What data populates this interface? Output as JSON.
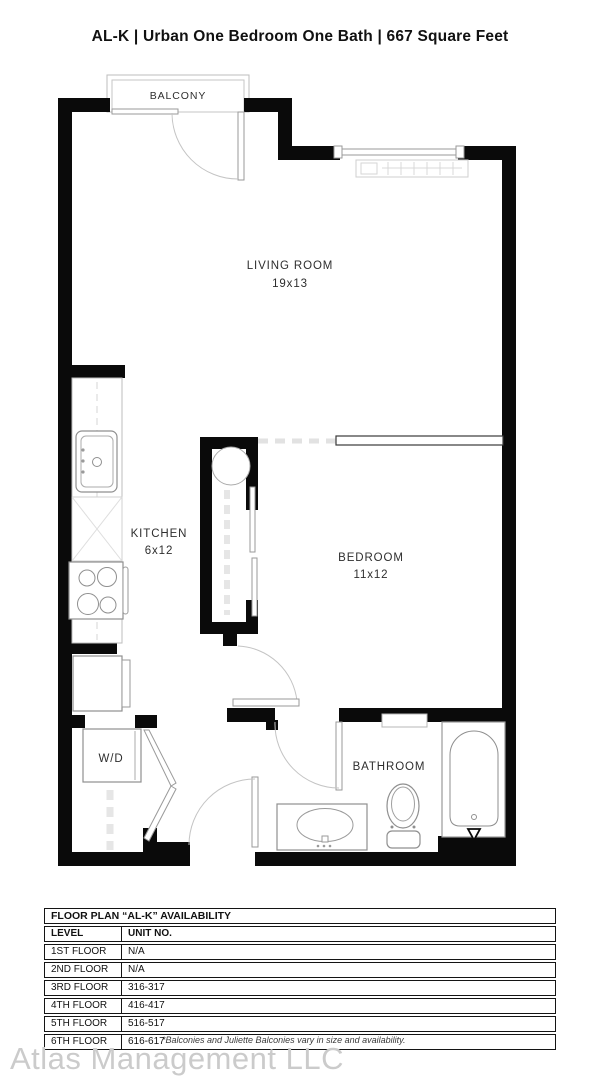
{
  "title": "AL-K | Urban One Bedroom One Bath | 667 Square Feet",
  "floor_plan": {
    "rooms": {
      "balcony": {
        "label": "BALCONY"
      },
      "living_room": {
        "label": "LIVING ROOM",
        "dimensions": "19x13"
      },
      "kitchen": {
        "label": "KITCHEN",
        "dimensions": "6x12"
      },
      "bedroom": {
        "label": "BEDROOM",
        "dimensions": "11x12"
      },
      "bathroom": {
        "label": "BATHROOM"
      },
      "washer_dryer": {
        "label": "W/D"
      }
    }
  },
  "availability_table": {
    "title": "FLOOR PLAN “AL-K” AVAILABILITY",
    "columns": [
      "LEVEL",
      "UNIT NO."
    ],
    "rows": [
      {
        "level": "1ST FLOOR",
        "unit_no": "N/A"
      },
      {
        "level": "2ND FLOOR",
        "unit_no": "N/A"
      },
      {
        "level": "3RD FLOOR",
        "unit_no": "316-317"
      },
      {
        "level": "4TH FLOOR",
        "unit_no": "416-417"
      },
      {
        "level": "5TH FLOOR",
        "unit_no": "516-517"
      },
      {
        "level": "6TH FLOOR",
        "unit_no": "616-617"
      }
    ]
  },
  "footer": {
    "watermark": "Atlas Management LLC",
    "disclaimer": "*Balconies and Juliette Balconies vary in size and availability."
  },
  "colors": {
    "wall": "#0a0a0a",
    "text": "#2e2e2e",
    "watermark": "#cbcbcb"
  }
}
